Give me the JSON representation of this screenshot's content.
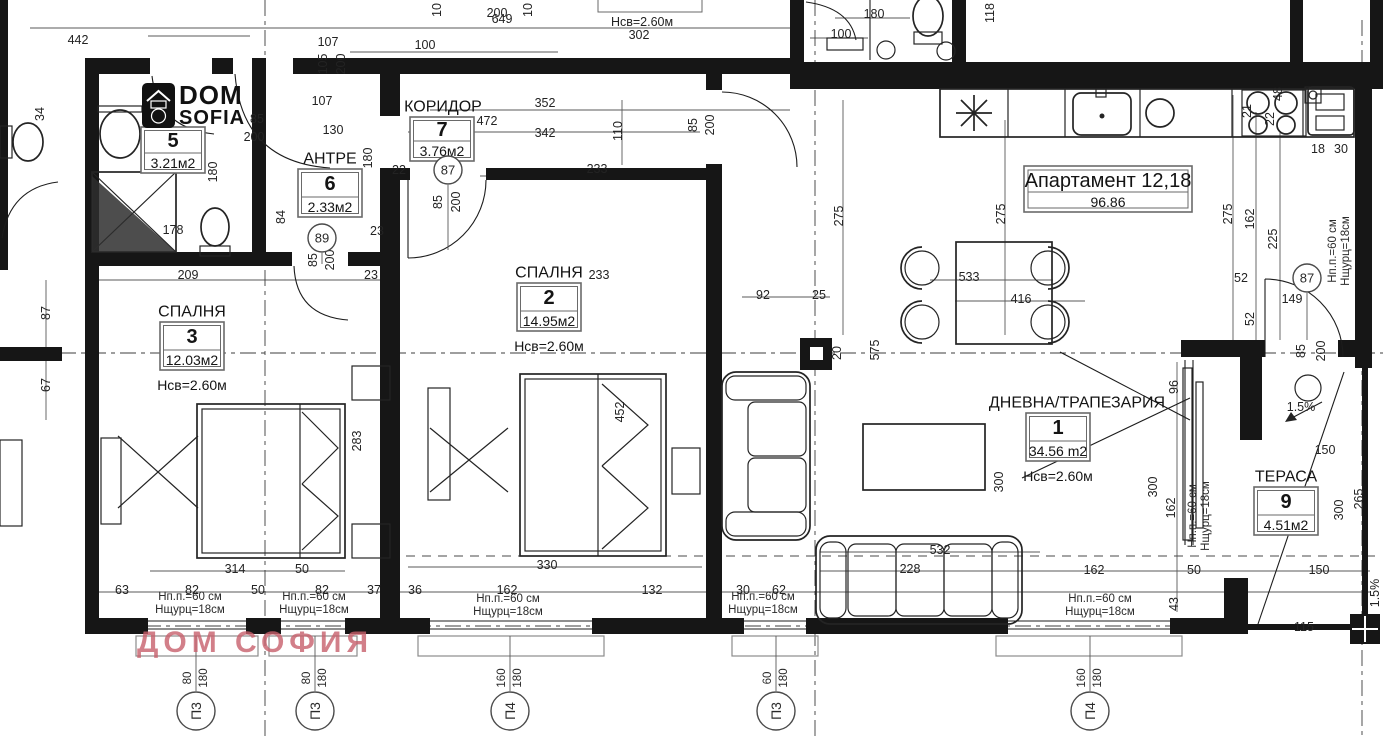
{
  "logo": {
    "line1": "DOM",
    "line2": "SOFIA"
  },
  "watermark": "ДОМ СОФИЯ",
  "apartment_label": {
    "title": "Апартамент 12,18",
    "area": "96.86"
  },
  "sill_text": {
    "l1": "Нп.п.=60 см",
    "l2": "Нщурц=18см"
  },
  "rooms": [
    {
      "name": "ДНЕВНА/ТРАПЕЗАРИЯ",
      "number": "1",
      "area": "34.56 m2",
      "height": "Нсв=2.60м",
      "x": 1026,
      "y": 413,
      "w": 64,
      "h": 48,
      "nx": 1077
    },
    {
      "name": "СПАЛНЯ",
      "number": "2",
      "area": "14.95м2",
      "height": "Нсв=2.60м",
      "x": 517,
      "y": 283,
      "w": 64,
      "h": 48,
      "nx": 549
    },
    {
      "name": "СПАЛНЯ",
      "number": "3",
      "area": "12.03м2",
      "height": "Нсв=2.60м",
      "x": 160,
      "y": 322,
      "w": 64,
      "h": 48,
      "nx": 192
    },
    {
      "name": "",
      "number": "5",
      "area": "3.21м2",
      "height": "",
      "x": 141,
      "y": 127,
      "w": 64,
      "h": 46,
      "nx": 173
    },
    {
      "name": "АНТРЕ",
      "number": "6",
      "area": "2.33м2",
      "height": "",
      "x": 298,
      "y": 169,
      "w": 64,
      "h": 48,
      "nx": 330
    },
    {
      "name": "КОРИДОР",
      "number": "7",
      "area": "3.76м2",
      "height": "",
      "x": 410,
      "y": 117,
      "w": 64,
      "h": 44,
      "nx": 443
    },
    {
      "name": "ТЕРАСА",
      "number": "9",
      "area": "4.51м2",
      "height": "",
      "x": 1254,
      "y": 487,
      "w": 64,
      "h": 48,
      "nx": 1286
    }
  ],
  "circle_markers": [
    {
      "t": "87",
      "x": 448,
      "y": 170
    },
    {
      "t": "89",
      "x": 322,
      "y": 238
    },
    {
      "t": "87",
      "x": 1307,
      "y": 278
    }
  ],
  "window_markers": [
    {
      "label": "П3",
      "w": "80",
      "h": "180",
      "x": 196
    },
    {
      "label": "П3",
      "w": "80",
      "h": "180",
      "x": 315
    },
    {
      "label": "П4",
      "w": "160",
      "h": "180",
      "x": 510
    },
    {
      "label": "П3",
      "w": "60",
      "h": "180",
      "x": 776
    },
    {
      "label": "П4",
      "w": "160",
      "h": "180",
      "x": 1090
    }
  ],
  "sill_labels": [
    {
      "x": 190,
      "y": 597,
      "r": 0
    },
    {
      "x": 314,
      "y": 597,
      "r": 0
    },
    {
      "x": 508,
      "y": 599,
      "r": 0
    },
    {
      "x": 763,
      "y": 597,
      "r": 0
    },
    {
      "x": 1100,
      "y": 599,
      "r": 0
    },
    {
      "x": 1193,
      "y": 516,
      "r": -90
    },
    {
      "x": 1333,
      "y": 251,
      "r": -90
    }
  ],
  "dimensions": [
    {
      "t": "649",
      "x": 502,
      "y": 19,
      "r": 0
    },
    {
      "t": "442",
      "x": 78,
      "y": 40,
      "r": 0
    },
    {
      "t": "107",
      "x": 328,
      "y": 42,
      "r": 0
    },
    {
      "t": "105",
      "x": 323,
      "y": 64,
      "r": -90
    },
    {
      "t": "200",
      "x": 341,
      "y": 64,
      "r": -90
    },
    {
      "t": "100",
      "x": 425,
      "y": 45,
      "r": 0
    },
    {
      "t": "10",
      "x": 437,
      "y": 10,
      "r": -90
    },
    {
      "t": "200",
      "x": 497,
      "y": 13,
      "r": 0
    },
    {
      "t": "10",
      "x": 528,
      "y": 10,
      "r": -90
    },
    {
      "t": "Нсв=2.60м",
      "x": 642,
      "y": 22,
      "r": 0
    },
    {
      "t": "302",
      "x": 639,
      "y": 35,
      "r": 0
    },
    {
      "t": "107",
      "x": 322,
      "y": 101,
      "r": 0
    },
    {
      "t": "130",
      "x": 333,
      "y": 130,
      "r": 0
    },
    {
      "t": "85",
      "x": 257,
      "y": 119,
      "r": 0
    },
    {
      "t": "200",
      "x": 254,
      "y": 137,
      "r": 0
    },
    {
      "t": "180",
      "x": 213,
      "y": 172,
      "r": -90
    },
    {
      "t": "352",
      "x": 545,
      "y": 103,
      "r": 0
    },
    {
      "t": "472",
      "x": 487,
      "y": 121,
      "r": 0
    },
    {
      "t": "342",
      "x": 545,
      "y": 133,
      "r": 0
    },
    {
      "t": "110",
      "x": 618,
      "y": 131,
      "r": -90
    },
    {
      "t": "233",
      "x": 597,
      "y": 169,
      "r": 0
    },
    {
      "t": "22",
      "x": 399,
      "y": 170,
      "r": 0
    },
    {
      "t": "85",
      "x": 438,
      "y": 202,
      "r": -90
    },
    {
      "t": "200",
      "x": 456,
      "y": 202,
      "r": -90
    },
    {
      "t": "180",
      "x": 368,
      "y": 158,
      "r": -90
    },
    {
      "t": "84",
      "x": 281,
      "y": 217,
      "r": -90
    },
    {
      "t": "85",
      "x": 313,
      "y": 260,
      "r": -90
    },
    {
      "t": "200",
      "x": 330,
      "y": 260,
      "r": -90
    },
    {
      "t": "23",
      "x": 377,
      "y": 231,
      "r": 0
    },
    {
      "t": "209",
      "x": 188,
      "y": 275,
      "r": 0
    },
    {
      "t": "23",
      "x": 371,
      "y": 275,
      "r": 0
    },
    {
      "t": "178",
      "x": 173,
      "y": 230,
      "r": 0
    },
    {
      "t": "34",
      "x": 40,
      "y": 114,
      "r": -90
    },
    {
      "t": "87",
      "x": 46,
      "y": 313,
      "r": -90
    },
    {
      "t": "67",
      "x": 46,
      "y": 385,
      "r": -90
    },
    {
      "t": "180",
      "x": 874,
      "y": 14,
      "r": 0
    },
    {
      "t": "100",
      "x": 841,
      "y": 34,
      "r": 0
    },
    {
      "t": "118",
      "x": 990,
      "y": 13,
      "r": -90
    },
    {
      "t": "21",
      "x": 1247,
      "y": 111,
      "r": -90
    },
    {
      "t": "22",
      "x": 1270,
      "y": 119,
      "r": -90
    },
    {
      "t": "48",
      "x": 1278,
      "y": 94,
      "r": -90
    },
    {
      "t": "18",
      "x": 1318,
      "y": 149,
      "r": 0
    },
    {
      "t": "30",
      "x": 1341,
      "y": 149,
      "r": 0
    },
    {
      "t": "275",
      "x": 839,
      "y": 216,
      "r": -90
    },
    {
      "t": "275",
      "x": 1001,
      "y": 214,
      "r": -90
    },
    {
      "t": "275",
      "x": 1228,
      "y": 214,
      "r": -90
    },
    {
      "t": "162",
      "x": 1250,
      "y": 219,
      "r": -90
    },
    {
      "t": "225",
      "x": 1273,
      "y": 239,
      "r": -90
    },
    {
      "t": "52",
      "x": 1241,
      "y": 278,
      "r": 0
    },
    {
      "t": "149",
      "x": 1292,
      "y": 299,
      "r": 0
    },
    {
      "t": "52",
      "x": 1250,
      "y": 319,
      "r": -90
    },
    {
      "t": "85",
      "x": 693,
      "y": 125,
      "r": -90
    },
    {
      "t": "200",
      "x": 710,
      "y": 125,
      "r": -90
    },
    {
      "t": "92",
      "x": 763,
      "y": 295,
      "r": 0
    },
    {
      "t": "25",
      "x": 819,
      "y": 295,
      "r": 0
    },
    {
      "t": "533",
      "x": 969,
      "y": 277,
      "r": 0
    },
    {
      "t": "416",
      "x": 1021,
      "y": 299,
      "r": 0
    },
    {
      "t": "575",
      "x": 875,
      "y": 350,
      "r": -90
    },
    {
      "t": "20",
      "x": 837,
      "y": 353,
      "r": -90
    },
    {
      "t": "96",
      "x": 1174,
      "y": 387,
      "r": -90
    },
    {
      "t": "85",
      "x": 1301,
      "y": 351,
      "r": -90
    },
    {
      "t": "200",
      "x": 1321,
      "y": 351,
      "r": -90
    },
    {
      "t": "1.5%",
      "x": 1301,
      "y": 407,
      "r": 0
    },
    {
      "t": "300",
      "x": 999,
      "y": 482,
      "r": -90
    },
    {
      "t": "300",
      "x": 1153,
      "y": 487,
      "r": -90
    },
    {
      "t": "162",
      "x": 1171,
      "y": 508,
      "r": -90
    },
    {
      "t": "233",
      "x": 599,
      "y": 275,
      "r": 0
    },
    {
      "t": "452",
      "x": 620,
      "y": 412,
      "r": -90
    },
    {
      "t": "283",
      "x": 357,
      "y": 441,
      "r": -90
    },
    {
      "t": "314",
      "x": 235,
      "y": 569,
      "r": 0
    },
    {
      "t": "50",
      "x": 302,
      "y": 569,
      "r": 0
    },
    {
      "t": "63",
      "x": 122,
      "y": 590,
      "r": 0
    },
    {
      "t": "82",
      "x": 192,
      "y": 590,
      "r": 0
    },
    {
      "t": "50",
      "x": 258,
      "y": 590,
      "r": 0
    },
    {
      "t": "82",
      "x": 322,
      "y": 590,
      "r": 0
    },
    {
      "t": "37",
      "x": 374,
      "y": 590,
      "r": 0
    },
    {
      "t": "36",
      "x": 415,
      "y": 590,
      "r": 0
    },
    {
      "t": "162",
      "x": 507,
      "y": 590,
      "r": 0
    },
    {
      "t": "132",
      "x": 652,
      "y": 590,
      "r": 0
    },
    {
      "t": "330",
      "x": 547,
      "y": 565,
      "r": 0
    },
    {
      "t": "30",
      "x": 743,
      "y": 590,
      "r": 0
    },
    {
      "t": "62",
      "x": 779,
      "y": 590,
      "r": 0
    },
    {
      "t": "532",
      "x": 940,
      "y": 550,
      "r": 0
    },
    {
      "t": "228",
      "x": 910,
      "y": 569,
      "r": 0
    },
    {
      "t": "162",
      "x": 1094,
      "y": 570,
      "r": 0
    },
    {
      "t": "50",
      "x": 1194,
      "y": 570,
      "r": 0
    },
    {
      "t": "150",
      "x": 1319,
      "y": 570,
      "r": 0
    },
    {
      "t": "43",
      "x": 1174,
      "y": 604,
      "r": -90
    },
    {
      "t": "115",
      "x": 1304,
      "y": 627,
      "r": 0
    },
    {
      "t": "1.5%",
      "x": 1375,
      "y": 593,
      "r": -90
    },
    {
      "t": "150",
      "x": 1325,
      "y": 450,
      "r": 0
    },
    {
      "t": "300",
      "x": 1339,
      "y": 510,
      "r": -90
    },
    {
      "t": "265",
      "x": 1359,
      "y": 499,
      "r": -90
    }
  ],
  "colors": {
    "ink": "#161616",
    "watermark": "#c8606c"
  }
}
